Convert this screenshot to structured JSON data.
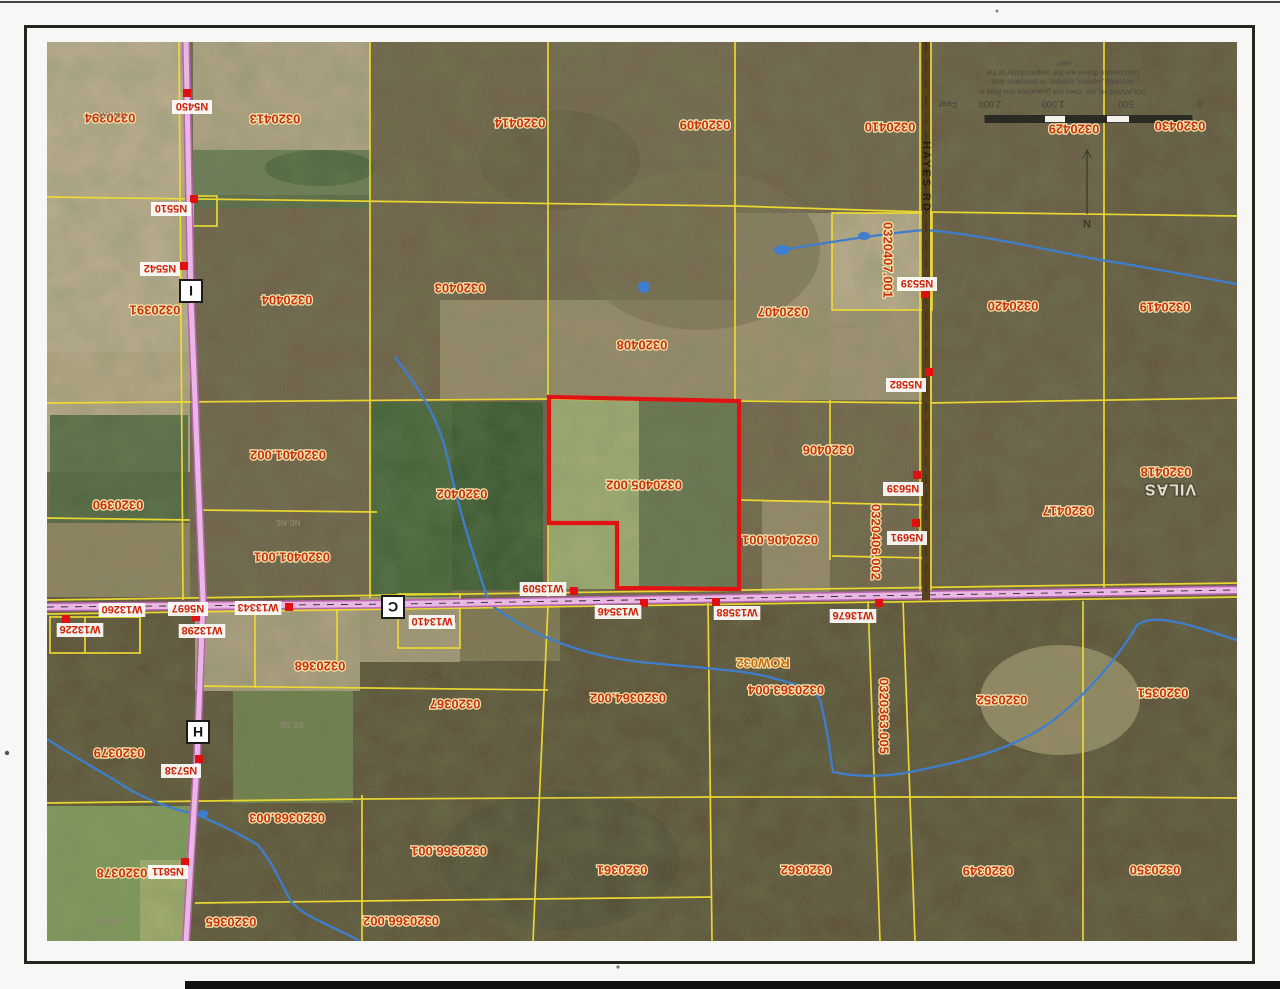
{
  "map": {
    "county_label": "VILAS",
    "highlighted_parcel": "0320405.002",
    "colors": {
      "parcel_line_yellow": "#f0dc30",
      "highlight_red": "#e31212",
      "road_pink": "#eab6e4",
      "hayes_road_dark": "#55431f",
      "stream_blue": "#3f7ecc",
      "parcel_text_red": "#c8330e"
    },
    "labels": [
      {
        "kind": "parcel",
        "text": "0320394",
        "x": 110,
        "y": 118
      },
      {
        "kind": "parcel",
        "text": "0320413",
        "x": 275,
        "y": 119
      },
      {
        "kind": "parcel",
        "text": "0320414",
        "x": 520,
        "y": 123
      },
      {
        "kind": "parcel",
        "text": "0320409",
        "x": 705,
        "y": 125
      },
      {
        "kind": "parcel",
        "text": "0320410",
        "x": 890,
        "y": 127
      },
      {
        "kind": "parcel",
        "text": "0320430",
        "x": 1180,
        "y": 126
      },
      {
        "kind": "parcel",
        "text": "0320429",
        "x": 1074,
        "y": 129
      },
      {
        "kind": "parcel",
        "text": "0320391",
        "x": 155,
        "y": 310
      },
      {
        "kind": "parcel",
        "text": "0320404",
        "x": 287,
        "y": 300
      },
      {
        "kind": "parcel",
        "text": "0320403",
        "x": 460,
        "y": 288
      },
      {
        "kind": "parcel",
        "text": "0320408",
        "x": 642,
        "y": 345
      },
      {
        "kind": "parcel",
        "text": "0320407",
        "x": 783,
        "y": 312
      },
      {
        "kind": "parcel",
        "text": "0320420",
        "x": 1013,
        "y": 306
      },
      {
        "kind": "parcel",
        "text": "0320419",
        "x": 1165,
        "y": 307
      },
      {
        "kind": "parcel",
        "text": "0320401.002",
        "x": 288,
        "y": 455
      },
      {
        "kind": "parcel",
        "text": "0320390",
        "x": 118,
        "y": 505
      },
      {
        "kind": "parcel",
        "text": "0320401.001",
        "x": 292,
        "y": 557
      },
      {
        "kind": "parcel",
        "text": "0320402",
        "x": 462,
        "y": 494
      },
      {
        "kind": "parcel",
        "text": "0320405.002",
        "x": 644,
        "y": 485
      },
      {
        "kind": "parcel",
        "text": "0320406",
        "x": 828,
        "y": 450
      },
      {
        "kind": "parcel",
        "text": "0320406.001",
        "x": 780,
        "y": 540
      },
      {
        "kind": "parcel",
        "text": "0320417",
        "x": 1068,
        "y": 511
      },
      {
        "kind": "parcel",
        "text": "0320418",
        "x": 1166,
        "y": 472
      },
      {
        "kind": "parcel",
        "text": "0320368",
        "x": 320,
        "y": 666
      },
      {
        "kind": "parcel",
        "text": "0320367",
        "x": 455,
        "y": 704
      },
      {
        "kind": "parcel",
        "text": "0320364.002",
        "x": 628,
        "y": 698
      },
      {
        "kind": "parcel",
        "text": "0320363.004",
        "x": 786,
        "y": 690
      },
      {
        "kind": "parcel",
        "text": "0320379",
        "x": 119,
        "y": 753
      },
      {
        "kind": "parcel",
        "text": "0320368.003",
        "x": 287,
        "y": 818
      },
      {
        "kind": "parcel",
        "text": "0320378",
        "x": 122,
        "y": 873
      },
      {
        "kind": "parcel",
        "text": "0320365",
        "x": 231,
        "y": 922
      },
      {
        "kind": "parcel",
        "text": "0320366.002",
        "x": 401,
        "y": 921
      },
      {
        "kind": "parcel",
        "text": "0320366.001",
        "x": 449,
        "y": 851
      },
      {
        "kind": "parcel",
        "text": "0320361",
        "x": 622,
        "y": 870
      },
      {
        "kind": "parcel",
        "text": "0320362",
        "x": 806,
        "y": 870
      },
      {
        "kind": "parcel",
        "text": "0320349",
        "x": 988,
        "y": 871
      },
      {
        "kind": "parcel",
        "text": "0320350",
        "x": 1155,
        "y": 870
      },
      {
        "kind": "parcel",
        "text": "0320351",
        "x": 1163,
        "y": 693
      },
      {
        "kind": "parcel",
        "text": "0320352",
        "x": 1002,
        "y": 700
      },
      {
        "kind": "vert",
        "text": "0320407.001",
        "x": 888,
        "y": 260
      },
      {
        "kind": "vert",
        "text": "0320406.002",
        "x": 876,
        "y": 542
      },
      {
        "kind": "vert",
        "text": "0320363.005",
        "x": 884,
        "y": 716
      },
      {
        "kind": "row",
        "text": "ROW032",
        "x": 763,
        "y": 663
      },
      {
        "kind": "chip",
        "text": "N5450",
        "x": 192,
        "y": 107
      },
      {
        "kind": "chip",
        "text": "N5510",
        "x": 171,
        "y": 209
      },
      {
        "kind": "chip",
        "text": "N5542",
        "x": 160,
        "y": 269
      },
      {
        "kind": "chip",
        "text": "N5539",
        "x": 917,
        "y": 284
      },
      {
        "kind": "chip",
        "text": "N5582",
        "x": 906,
        "y": 385
      },
      {
        "kind": "chip",
        "text": "N5639",
        "x": 903,
        "y": 489
      },
      {
        "kind": "chip",
        "text": "N5691",
        "x": 907,
        "y": 538
      },
      {
        "kind": "chip",
        "text": "N5697",
        "x": 188,
        "y": 609
      },
      {
        "kind": "chip",
        "text": "W13260",
        "x": 122,
        "y": 610
      },
      {
        "kind": "chip",
        "text": "W13226",
        "x": 80,
        "y": 630
      },
      {
        "kind": "chip",
        "text": "W13298",
        "x": 202,
        "y": 631
      },
      {
        "kind": "chip",
        "text": "W13343",
        "x": 258,
        "y": 608
      },
      {
        "kind": "chip",
        "text": "W13410",
        "x": 432,
        "y": 622
      },
      {
        "kind": "chip",
        "text": "W13509",
        "x": 543,
        "y": 589
      },
      {
        "kind": "chip",
        "text": "W13546",
        "x": 618,
        "y": 612
      },
      {
        "kind": "chip",
        "text": "W13588",
        "x": 737,
        "y": 613
      },
      {
        "kind": "chip",
        "text": "W13676",
        "x": 853,
        "y": 616
      },
      {
        "kind": "chip",
        "text": "N5738",
        "x": 181,
        "y": 771
      },
      {
        "kind": "chip",
        "text": "N5811",
        "x": 168,
        "y": 872
      },
      {
        "kind": "marker",
        "text": "I",
        "x": 191,
        "y": 291
      },
      {
        "kind": "marker",
        "text": "C",
        "x": 393,
        "y": 607
      },
      {
        "kind": "marker",
        "text": "H",
        "x": 198,
        "y": 732
      },
      {
        "kind": "section",
        "text": "NW-SW",
        "x": 112,
        "y": 115
      },
      {
        "kind": "section",
        "text": "SW-NW",
        "x": 845,
        "y": 326
      },
      {
        "kind": "section",
        "text": "SW-NE",
        "x": 478,
        "y": 325
      },
      {
        "kind": "section",
        "text": "NE-NE",
        "x": 288,
        "y": 523
      },
      {
        "kind": "section",
        "text": "SE-SE",
        "x": 292,
        "y": 725
      },
      {
        "kind": "section",
        "text": "NE-NW",
        "x": 108,
        "y": 921
      },
      {
        "kind": "county",
        "text": "VILAS",
        "x": 1170,
        "y": 490
      },
      {
        "kind": "roadv",
        "text": "HAYES RD",
        "x": 927,
        "y": 177
      },
      {
        "kind": "compass",
        "text": "N",
        "x": 1087,
        "y": 224
      }
    ],
    "scale_bar": {
      "numbers": [
        {
          "text": "Feet",
          "x": 948
        },
        {
          "text": "2,000",
          "x": 990
        },
        {
          "text": "1,000",
          "x": 1053
        },
        {
          "text": "500",
          "x": 1126
        },
        {
          "text": "0",
          "x": 1200
        }
      ]
    },
    "disclaimer_lines": [
      {
        "text": "user.",
        "y": 64
      },
      {
        "text": "conclusions drawn are the responsibility of the",
        "y": 73
      },
      {
        "text": "accurate, correct, current, or complete and",
        "y": 82
      },
      {
        "text": "SOLA/VER HI, Inc. does not guarantee this data is",
        "y": 92
      }
    ]
  }
}
